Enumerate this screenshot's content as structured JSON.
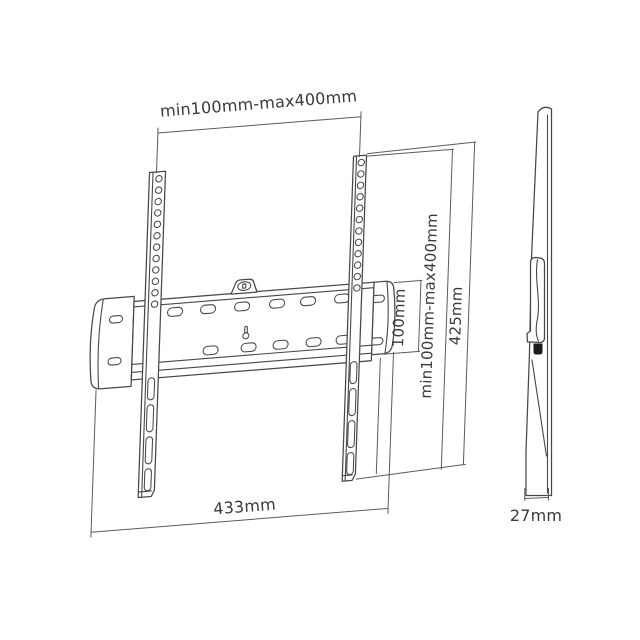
{
  "diagram": {
    "name": "tv-wall-mount-dimension-drawing",
    "views": {
      "front_view": "flat wall mount bracket with two vertical VESA rails and horizontal wall plate",
      "side_view": "thin side profile of mounted bracket"
    },
    "dimensions": {
      "top_span": "min100mm-max400mm",
      "plate_height": "100mm",
      "vertical_span": "min100mm-max400mm",
      "rail_height": "425mm",
      "plate_width": "433mm",
      "profile_depth": "27mm"
    },
    "colors": {
      "line": "#474747",
      "dim": "#5a5a5a",
      "text": "#3a3a3a",
      "background": "#ffffff",
      "hook": "#1c1c1c"
    }
  }
}
